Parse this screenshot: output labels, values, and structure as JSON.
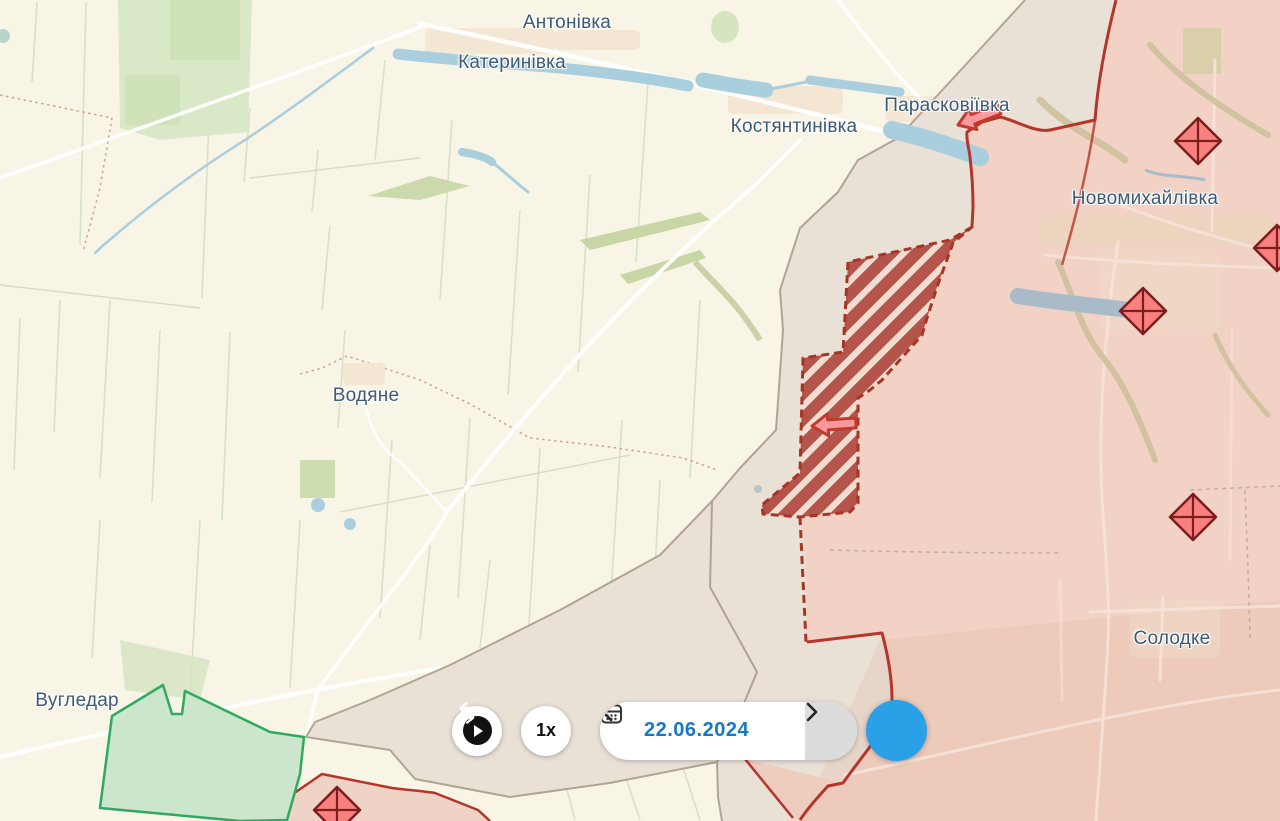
{
  "map": {
    "town_labels": [
      {
        "name": "Антонівка",
        "x": 567,
        "y": 23
      },
      {
        "name": "Катеринівка",
        "x": 512,
        "y": 63
      },
      {
        "name": "Костянтинівка",
        "x": 794,
        "y": 127
      },
      {
        "name": "Парасковіївка",
        "x": 947,
        "y": 106
      },
      {
        "name": "Новомихайлівка",
        "x": 1145,
        "y": 199
      },
      {
        "name": "Водяне",
        "x": 366,
        "y": 396
      },
      {
        "name": "Вугледар",
        "x": 77,
        "y": 701
      },
      {
        "name": "Солодке",
        "x": 1172,
        "y": 639
      }
    ],
    "fortification_markers": {
      "icon": "diamond-cross-icon",
      "positions": [
        {
          "x": 1198,
          "y": 141
        },
        {
          "x": 1143,
          "y": 311
        },
        {
          "x": 1193,
          "y": 517
        },
        {
          "x": 1277,
          "y": 248
        },
        {
          "x": 337,
          "y": 810
        }
      ]
    },
    "attack_arrows": [
      {
        "x": 958,
        "y": 125,
        "rotation": -21
      },
      {
        "x": 812,
        "y": 426,
        "rotation": -4
      }
    ],
    "legend_colors": {
      "occupied_fill": "#f1d2c5",
      "occupied_border": "#b4362a",
      "contested_stripe": "#b5544a",
      "grey_zone_fill": "#e9e0d6",
      "liberated_fill": "#cde6cf",
      "liberated_border": "#2faa5f",
      "water": "#a9cedd",
      "label_text": "#3d5a73"
    }
  },
  "timeline": {
    "speed": "1x",
    "date": "22.06.2024",
    "accent_blue": "#2aa0e7",
    "date_color": "#1879c2",
    "icons": [
      "play-icon",
      "chevron-left-icon",
      "calendar-icon",
      "chevron-right-icon",
      "swap-horizontal-icon"
    ]
  }
}
